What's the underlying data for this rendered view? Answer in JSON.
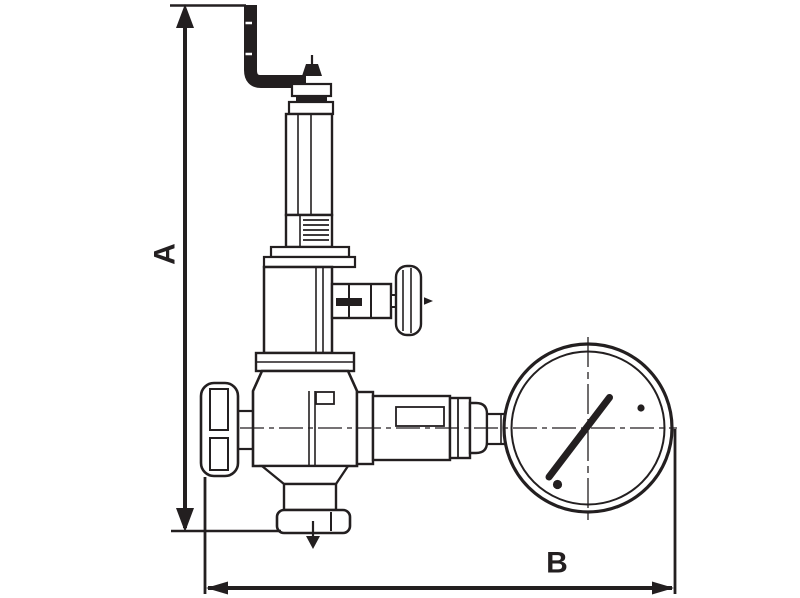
{
  "colors": {
    "ink": "#231f20",
    "paper": "#ffffff"
  },
  "dimension_labels": {
    "height": "A",
    "width": "B"
  }
}
